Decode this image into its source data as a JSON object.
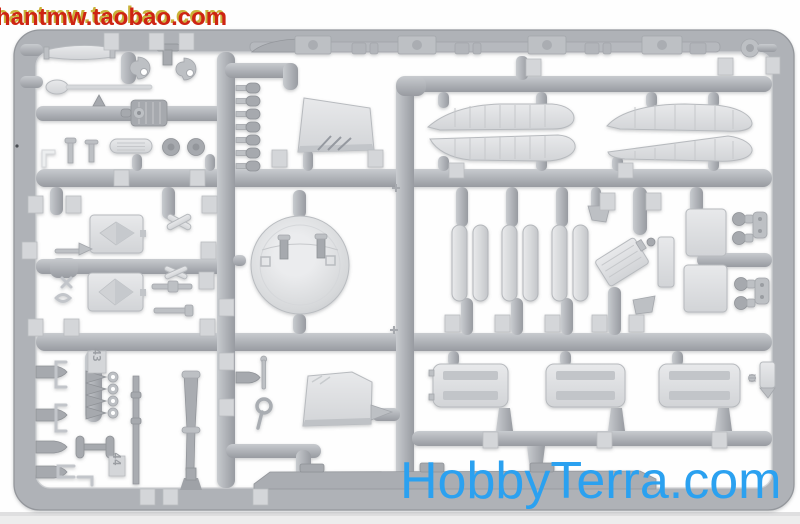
{
  "image": {
    "description": "Photo of a light-gray injection-molded plastic model kit sprue (parts frame) on a white background",
    "background_color": "#ffffff",
    "plastic_runner_color": "#b0b3b8",
    "plastic_part_color": "#dfe1e4"
  },
  "watermarks": {
    "top_left": {
      "text": "hantmw.taobao.com",
      "color": "#ce2413",
      "glow_color": "#c9b23a"
    },
    "bottom_right": {
      "text": "HobbyTerra.com",
      "color": "#2ba1f0"
    }
  },
  "sprue": {
    "part_number_tags": [
      "43",
      "44"
    ],
    "contents": [
      "deck beam with clamp blocks along top rail",
      "two pairs of pontoon hull halves",
      "two windshield / cabin glazing panels",
      "large round turret dome with posts",
      "six cylindrical float parts",
      "three slatted deck boxes",
      "two hatch plates with diamond covers",
      "row of seven bollard pins",
      "two tapered masts",
      "ladder of four eyelet fittings",
      "paddle, plank, winch drum, wheels and small fittings"
    ]
  }
}
